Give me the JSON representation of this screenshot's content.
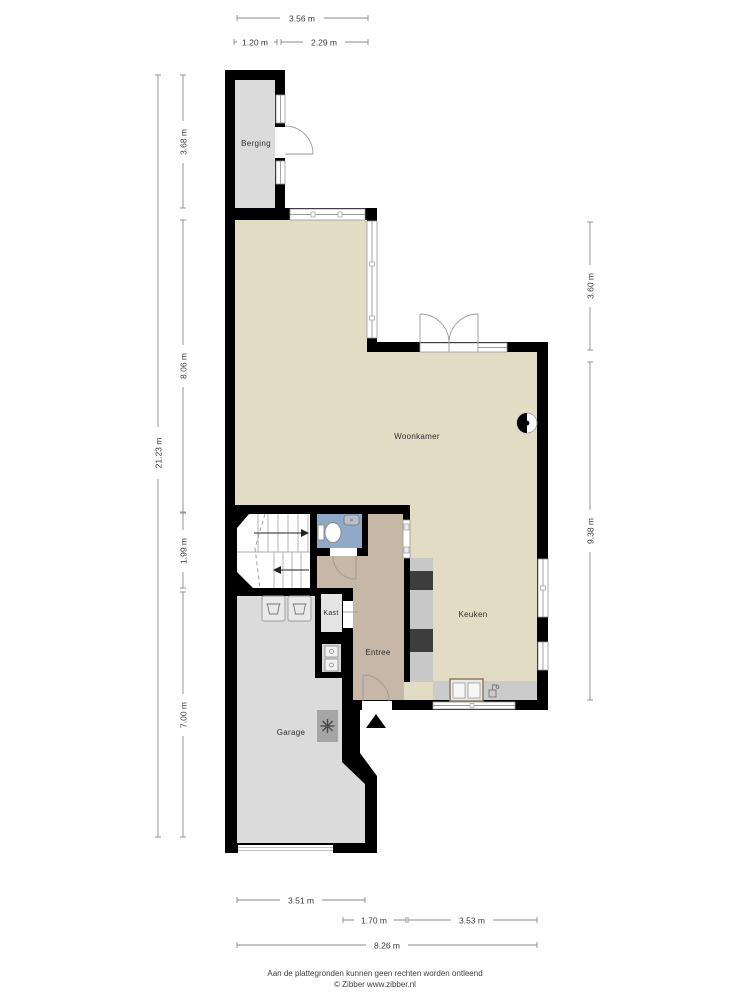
{
  "plan": {
    "rooms": {
      "berging": "Berging",
      "woonkamer": "Woonkamer",
      "keuken": "Keuken",
      "entree": "Entree",
      "kast": "Kast",
      "garage": "Garage"
    },
    "colors": {
      "wall": "#000000",
      "living_floor": "#e3dcc4",
      "hall_floor": "#c7b7a6",
      "wc_floor": "#8fa9c9",
      "storage_floor": "#dbdbdb",
      "counter": "#c8c8c8",
      "appliance": "#3d3d3d"
    }
  },
  "dim_top": {
    "total": "3.56 m",
    "segs": [
      "1.20 m",
      "2.29 m"
    ]
  },
  "dim_left": {
    "total": "21.23 m",
    "segs": [
      "3.68 m",
      "8.06 m",
      "1.99 m",
      "7.00 m"
    ]
  },
  "dim_right": {
    "segs": [
      "3.60 m",
      "9.38 m"
    ]
  },
  "dim_bottom": {
    "segs": [
      "3.51 m",
      "1.70 m",
      "3.53 m"
    ],
    "total": "8.26 m"
  },
  "footer": {
    "line1": "Aan de plattegronden kunnen geen rechten worden ontleend",
    "line2": "© Zibber www.zibber.nl"
  }
}
